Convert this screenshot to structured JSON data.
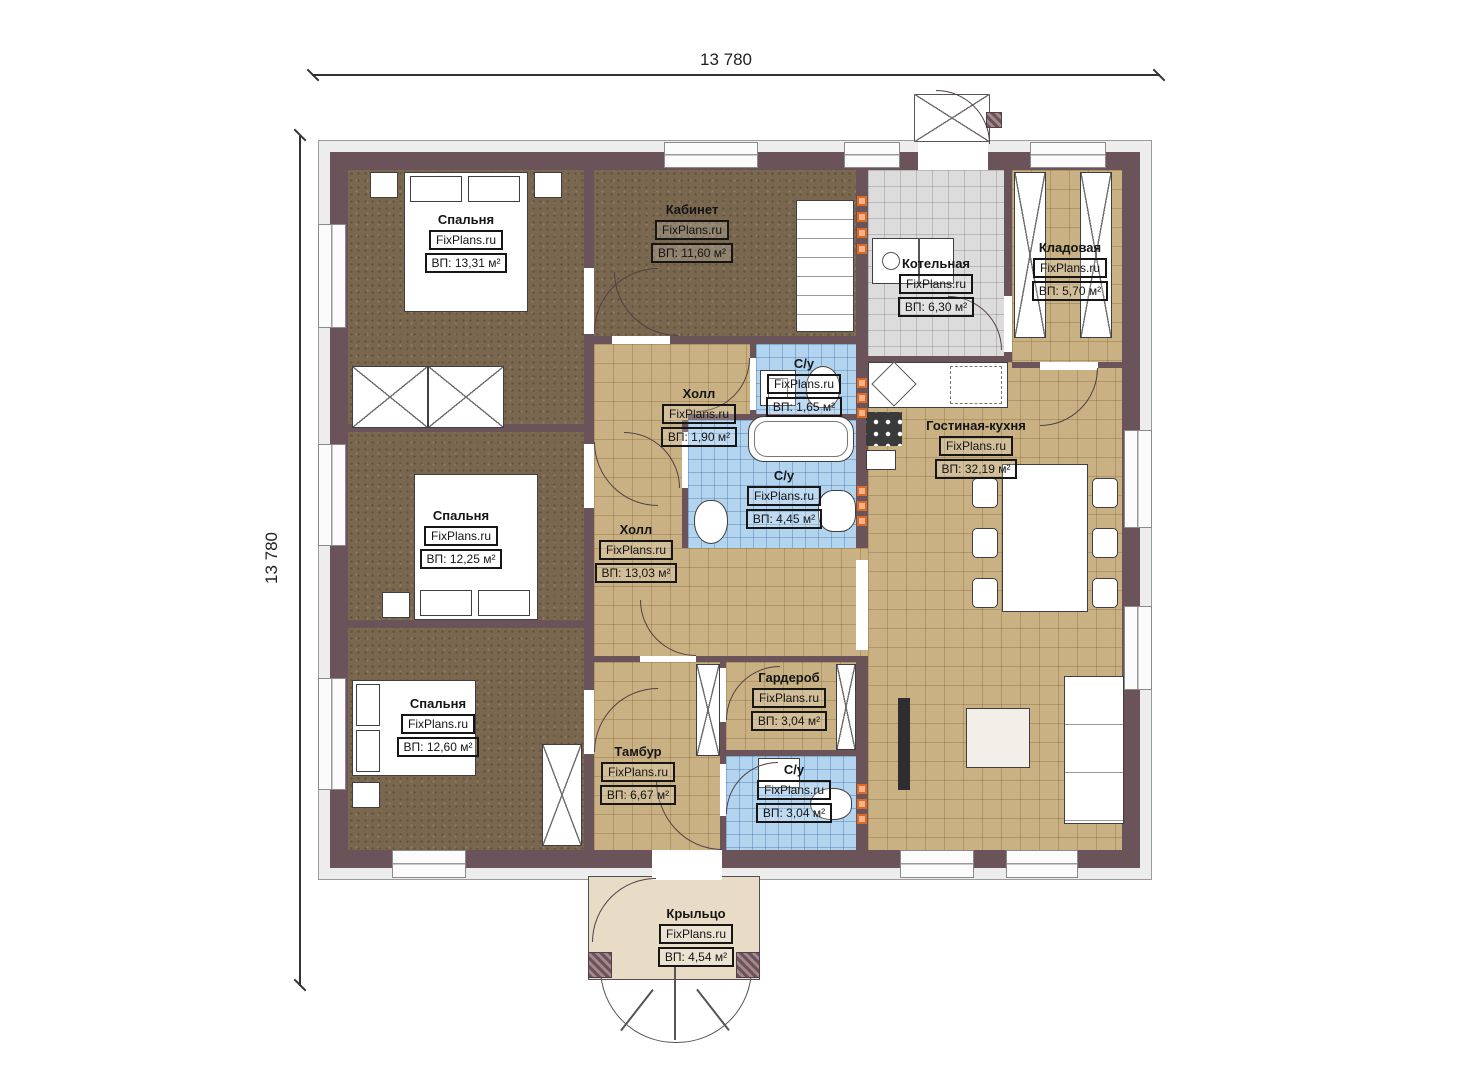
{
  "dimensions": {
    "top": "13 780",
    "left": "13 780"
  },
  "watermark": "FixPlans.ru",
  "rooms": [
    {
      "name": "Спальня",
      "watermark": "FixPlans.ru",
      "area": "ВП: 13,31 м²"
    },
    {
      "name": "Кабинет",
      "watermark": "FixPlans.ru",
      "area": "ВП: 11,60 м²"
    },
    {
      "name": "Котельная",
      "watermark": "FixPlans.ru",
      "area": "ВП: 6,30 м²"
    },
    {
      "name": "Кладовая",
      "watermark": "FixPlans.ru",
      "area": "ВП: 5,70 м²"
    },
    {
      "name": "Холл",
      "watermark": "FixPlans.ru",
      "area": "ВП: 1,90 м²"
    },
    {
      "name": "С/у",
      "watermark": "FixPlans.ru",
      "area": "ВП: 1,65 м²"
    },
    {
      "name": "С/у",
      "watermark": "FixPlans.ru",
      "area": "ВП: 4,45 м²"
    },
    {
      "name": "Гостиная-кухня",
      "watermark": "FixPlans.ru",
      "area": "ВП: 32,19 м²"
    },
    {
      "name": "Спальня",
      "watermark": "FixPlans.ru",
      "area": "ВП: 12,25 м²"
    },
    {
      "name": "Холл",
      "watermark": "FixPlans.ru",
      "area": "ВП: 13,03 м²"
    },
    {
      "name": "Спальня",
      "watermark": "FixPlans.ru",
      "area": "ВП: 12,60 м²"
    },
    {
      "name": "Гардероб",
      "watermark": "FixPlans.ru",
      "area": "ВП: 3,04 м²"
    },
    {
      "name": "Тамбур",
      "watermark": "FixPlans.ru",
      "area": "ВП: 6,67 м²"
    },
    {
      "name": "С/у",
      "watermark": "FixPlans.ru",
      "area": "ВП: 3,04 м²"
    },
    {
      "name": "Крыльцо",
      "watermark": "FixPlans.ru",
      "area": "ВП: 4,54 м²"
    }
  ],
  "colors": {
    "wall": "#6a545a",
    "floor_wood": "#79684f",
    "tile_tan": "#c9b184",
    "tile_grey": "#dcdcdc",
    "tile_blue": "#b3d4ee",
    "porch": "#e8dcc7",
    "riser": "#d96a28"
  }
}
